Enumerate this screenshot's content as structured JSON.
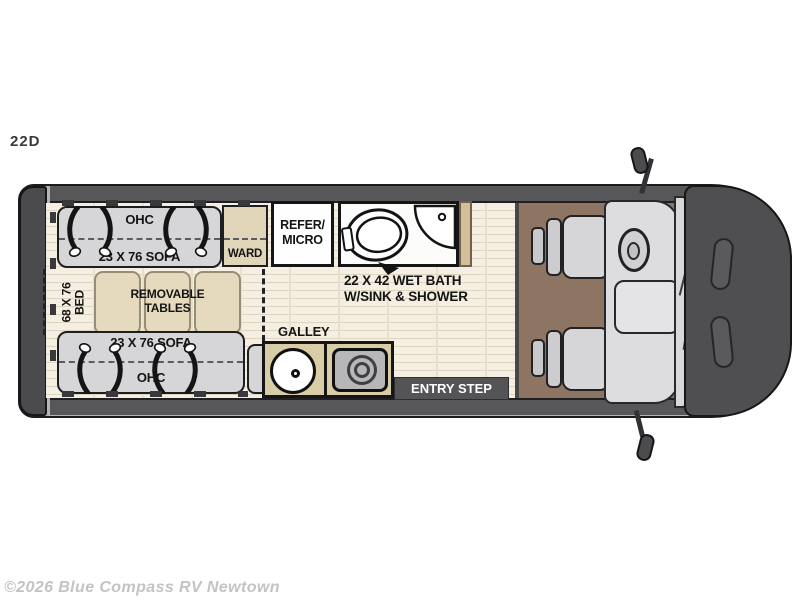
{
  "model_label": "22D",
  "watermark": "©2026 Blue Compass RV Newtown",
  "floorplan": {
    "sofa_top": {
      "ohc": "OHC",
      "label": "23 X 76 SOFA"
    },
    "sofa_bottom": {
      "label": "23 X 76 SOFA",
      "ohc": "OHC"
    },
    "bed": {
      "line1": "68 X 76",
      "line2": "BED"
    },
    "tables": {
      "line1": "REMOVABLE",
      "line2": "TABLES"
    },
    "ward": "WARD",
    "refer": {
      "line1": "REFER/",
      "line2": "MICRO"
    },
    "wet_bath": {
      "line1": "22 X 42 WET BATH",
      "line2": "W/SINK & SHOWER"
    },
    "galley": "GALLEY",
    "entry_step": "ENTRY STEP"
  },
  "colors": {
    "body_gray": "#b4b4b6",
    "dark_gray": "#4b4b4d",
    "sofa_gray": "#d6d6d8",
    "cabinet_tan": "#e0d5b9",
    "counter_tan": "#d9cda8",
    "floor_cream": "#f4efe2",
    "cab_floor_brown": "#8d7463",
    "entry_step_gray": "#545457",
    "watermark_gray": "#c3c3c3"
  }
}
